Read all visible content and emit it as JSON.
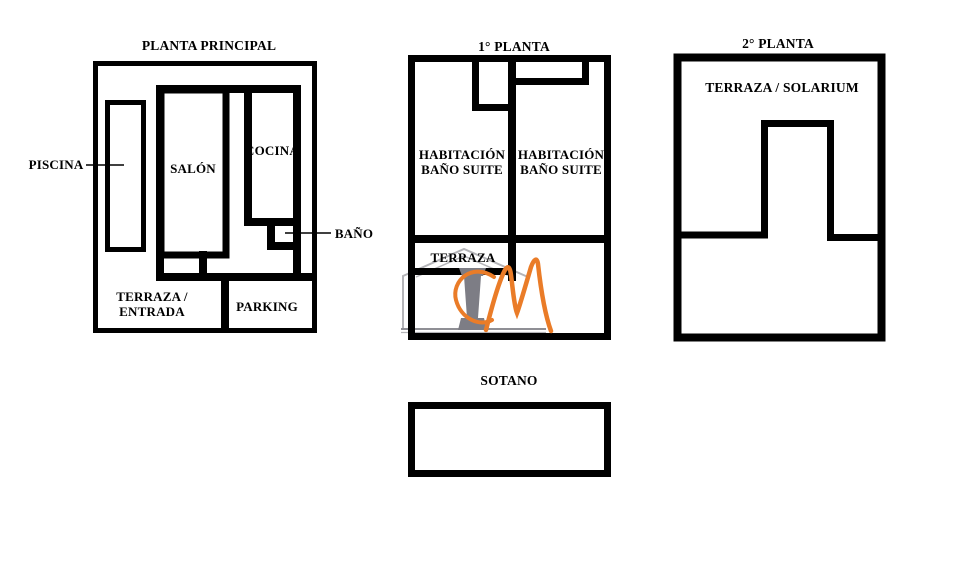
{
  "plans": {
    "planta_principal": {
      "title": "PLANTA PRINCIPAL",
      "labels": {
        "piscina": "PISCINA",
        "salon": "SALÓN",
        "cocina": "COCINA",
        "bano": "BAÑO",
        "terraza_entrada_line1": "TERRAZA /",
        "terraza_entrada_line2": "ENTRADA",
        "parking": "PARKING"
      }
    },
    "primera_planta": {
      "title": "1° PLANTA",
      "labels": {
        "habitacion_izq_line1": "HABITACIÓN",
        "habitacion_izq_line2": "BAÑO SUITE",
        "habitacion_der_line1": "HABITACIÓN",
        "habitacion_der_line2": "BAÑO SUITE",
        "terraza": "TERRAZA"
      }
    },
    "segunda_planta": {
      "title": "2° PLANTA",
      "labels": {
        "terraza_solarium": "TERRAZA / SOLARIUM"
      }
    },
    "sotano": {
      "title": "SOTANO"
    }
  },
  "watermark": {
    "letters": "CM",
    "orange": "#EA7C28",
    "column_gray": "#7D7D85",
    "outline_gray": "#B4B4B8",
    "baseline_gray": "#8F8F95"
  },
  "colors": {
    "wall": "#000000",
    "background": "#FFFFFF",
    "text": "#000000"
  }
}
